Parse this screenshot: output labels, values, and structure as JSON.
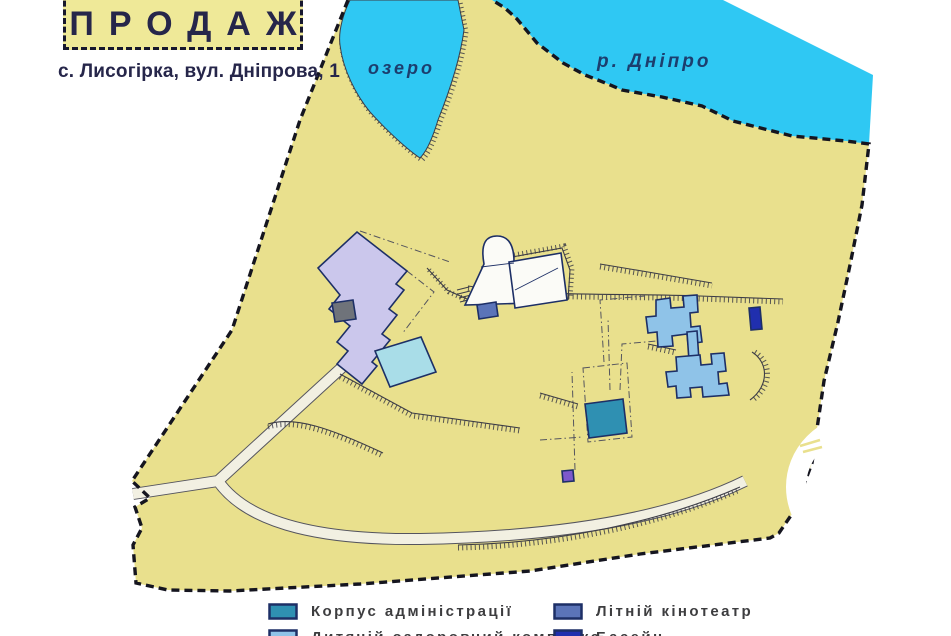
{
  "header": {
    "title": "ПРОДАЖ",
    "address": "с. Лисогірка, вул. Дніпрова, 1"
  },
  "map_labels": {
    "lake": "озеро",
    "river": "р. Дніпро"
  },
  "legend": {
    "items": [
      {
        "label": "Корпус адміністрації",
        "color": "#2f90b2"
      },
      {
        "label": "Дитячій оздоровчий комплекс",
        "color": "#8fc3e8"
      },
      {
        "label": "Літній кінотеатр",
        "color": "#5b74b8"
      },
      {
        "label": "Басейн",
        "color": "#202fae"
      }
    ],
    "swatch_border": "#1d2f66"
  },
  "colors": {
    "land": "#e9e08d",
    "water": "#2fc8f3",
    "road": "#f2f0e2",
    "title_box_bg": "#efe998",
    "building_admin": "#2f90b2",
    "building_cinema": "#5b74b8",
    "building_complex": "#8fc3e8",
    "building_navy": "#202fae",
    "building_lavender": "#cbc7ec",
    "building_cyan": "#a9dde8",
    "building_gray": "#6f737a",
    "building_white": "#fbfbf7",
    "building_purple": "#7d58cb"
  }
}
